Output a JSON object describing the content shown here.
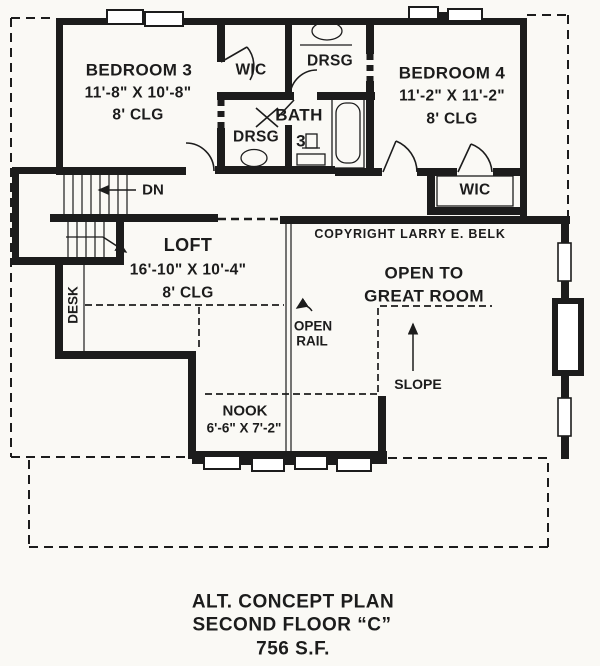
{
  "colors": {
    "ink": "#1c1c1c",
    "paper": "#faf9f5"
  },
  "rooms": {
    "bedroom3": {
      "name": "BEDROOM 3",
      "dims": "11'-8\" X 10'-8\"",
      "ceiling": "8' CLG"
    },
    "bedroom4": {
      "name": "BEDROOM 4",
      "dims": "11'-2\" X 11'-2\"",
      "ceiling": "8' CLG"
    },
    "loft": {
      "name": "LOFT",
      "dims": "16'-10\" X 10'-4\"",
      "ceiling": "8' CLG"
    },
    "nook": {
      "name": "NOOK",
      "dims": "6'-6\" X 7'-2\""
    },
    "wic_left": {
      "name": "WIC"
    },
    "wic_right": {
      "name": "WIC"
    },
    "drsg_upper": {
      "name": "DRSG"
    },
    "drsg_lower": {
      "name": "DRSG"
    },
    "bath": {
      "name": "BATH",
      "number": "3"
    },
    "great_room": {
      "line1": "OPEN TO",
      "line2": "GREAT ROOM"
    }
  },
  "annotations": {
    "down": "DN",
    "desk": "DESK",
    "open": "OPEN",
    "rail": "RAIL",
    "slope": "SLOPE",
    "copyright": "COPYRIGHT LARRY E. BELK"
  },
  "icons": [
    "stairs",
    "door-swing",
    "window",
    "bathtub-icon",
    "toilet-icon",
    "sink-icon",
    "chimney",
    "open-rail-line",
    "roof-overhang-outline"
  ],
  "title": {
    "line1": "ALT. CONCEPT PLAN",
    "line2": "SECOND FLOOR “C”",
    "line3": "756 S.F."
  }
}
